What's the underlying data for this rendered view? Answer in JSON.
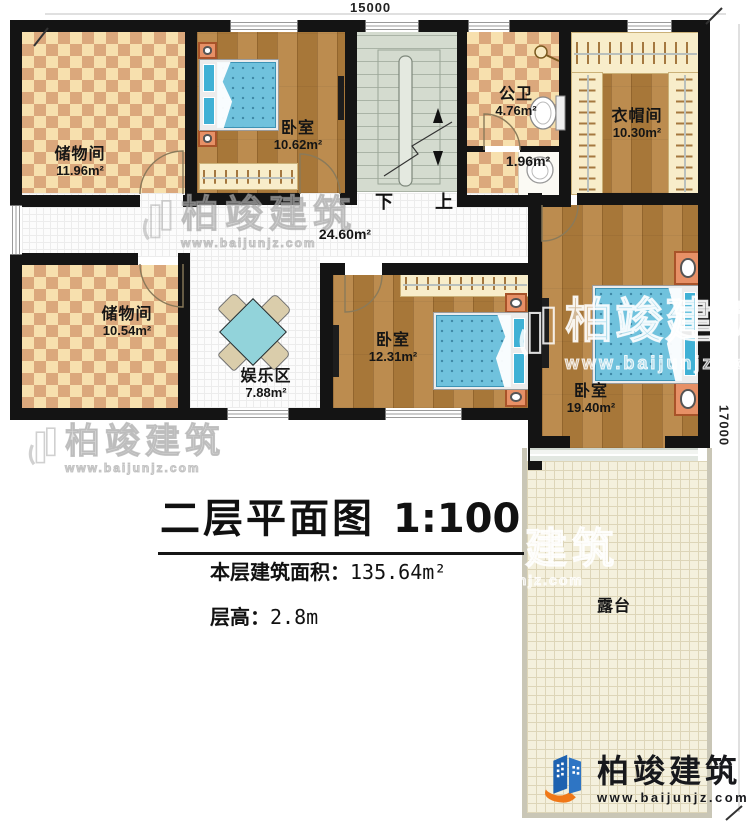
{
  "dimensions": {
    "top": "15000",
    "right": "17000"
  },
  "rooms": {
    "storage_top": {
      "label": "储物间",
      "area": "11.96m²"
    },
    "bedroom_top": {
      "label": "卧室",
      "area": "10.62m²"
    },
    "bathroom": {
      "label": "公卫",
      "area": "4.76m²"
    },
    "washroom": {
      "area": "1.96m²"
    },
    "cloakroom": {
      "label": "衣帽间",
      "area": "10.30m²"
    },
    "corridor": {
      "area": "24.60m²"
    },
    "storage_mid": {
      "label": "储物间",
      "area": "10.54m²"
    },
    "entertainment": {
      "label": "娱乐区",
      "area": "7.88m²"
    },
    "bedroom_mid": {
      "label": "卧室",
      "area": "12.31m²"
    },
    "bedroom_master": {
      "label": "卧室",
      "area": "19.40m²"
    },
    "terrace": {
      "label": "露台"
    }
  },
  "stairs": {
    "down": "下",
    "up": "上"
  },
  "title_block": {
    "title": "二层平面图",
    "scale": "1:100",
    "area_line_label": "本层建筑面积：",
    "area_line_value": "135.64m²",
    "height_line_label": "层高：",
    "height_line_value": "2.8m"
  },
  "watermark": {
    "name": "柏竣建筑",
    "url": "www.baijunjz.com"
  },
  "logo": {
    "name": "柏竣建筑",
    "url": "www.baijunjz.com"
  },
  "colors": {
    "wall": "#141414",
    "checker_light": "#f7e0ae",
    "checker_dark": "#dba87c",
    "wood": "#b5813e",
    "stairs": "#d4dbcf",
    "terrace": "#f4f0dd",
    "bed_blue": "#70c2dd",
    "logo_blue": "#1e62b0",
    "logo_orange": "#f07818"
  }
}
